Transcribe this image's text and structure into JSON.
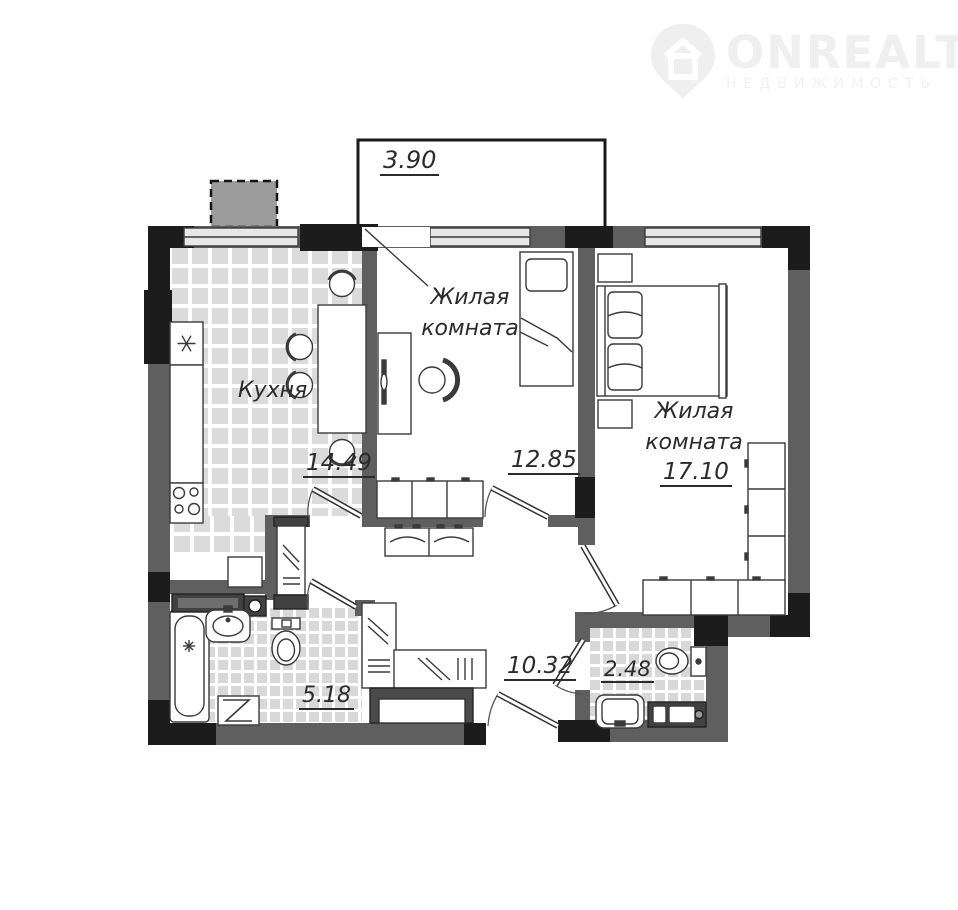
{
  "watermark": {
    "brand": "ONREALT",
    "subtitle": "НЕДВИЖИМОСТЬ"
  },
  "rooms": {
    "balcony": {
      "area": "3.90"
    },
    "kitchen": {
      "name": "Кухня",
      "area": "14.49"
    },
    "living_room_1": {
      "name_line1": "Жилая",
      "name_line2": "комната",
      "area": "12.85"
    },
    "living_room_2": {
      "name_line1": "Жилая",
      "name_line2": "комната",
      "area": "17.10"
    },
    "bathroom": {
      "area": "5.18"
    },
    "hallway": {
      "area": "10.32"
    },
    "wc": {
      "area": "2.48"
    }
  },
  "fixtures": {
    "kitchen": [
      "fridge",
      "counter",
      "stove",
      "dining-table",
      "four-chairs"
    ],
    "living_room_1": [
      "single-bed",
      "desk",
      "desk-chair",
      "wardrobe"
    ],
    "living_room_2": [
      "double-bed",
      "two-nightstands",
      "wardrobe-right",
      "wardrobe-bottom"
    ],
    "bathroom": [
      "bathtub",
      "counter-with-sink",
      "toilet",
      "washing-machine"
    ],
    "hallway": [
      "mirrored-wardrobe-tall",
      "mirrored-wardrobe-l-shape",
      "shoe-bench",
      "built-in-closet"
    ],
    "wc": [
      "toilet",
      "sink",
      "cabinet"
    ]
  },
  "colors": {
    "wall": "#5f5f5f",
    "wall_accent": "#1c1c1c",
    "window": "#e7e7e7",
    "tile_large": "#dbdbdb",
    "tile_small": "#d8d8d8",
    "outline": "#3a3a3a",
    "watermark": "#efefef"
  }
}
